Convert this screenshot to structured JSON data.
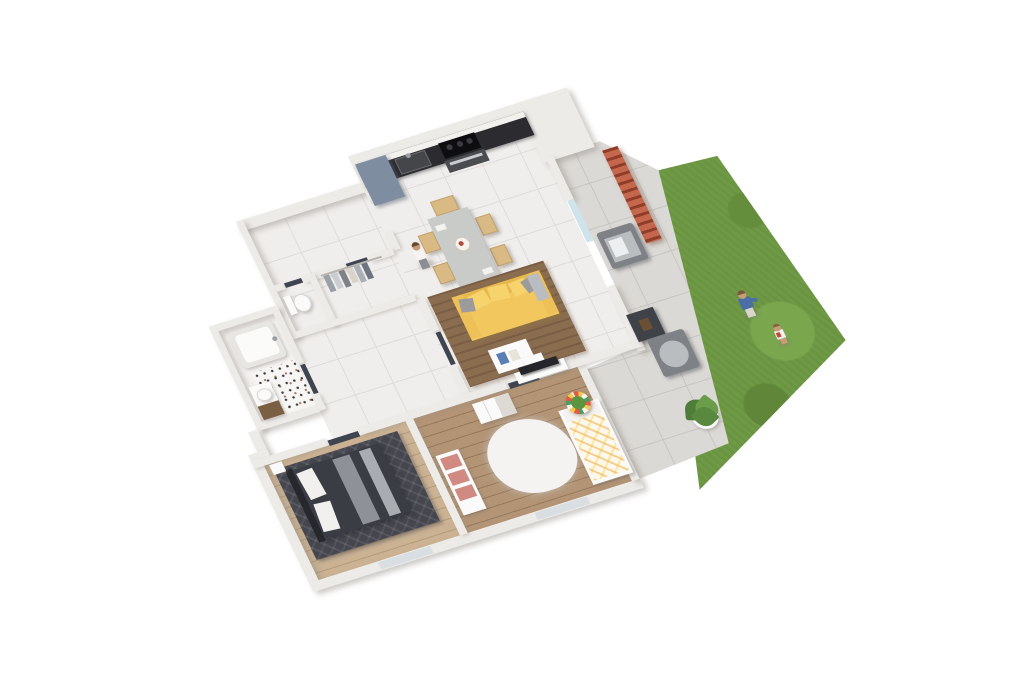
{
  "scene": {
    "type": "3d-architectural-floor-plan-render",
    "view": "axonometric top-down, plan rotated about 17 degrees",
    "background": "#ffffff",
    "text_visible": "none"
  },
  "palette": {
    "wall": "#edebe8",
    "door": "#3e4550",
    "tile": "#f0eeec",
    "tileLine": "#dedcd8",
    "pavement": "#dbd9d5",
    "paveLine": "#c7c5c1",
    "woodLight": "#cab293",
    "woodMid": "#b39475",
    "rugBrown": "#8a6c4f",
    "rugDark": "#45464e",
    "lawn": "#6f9a45",
    "brick": "#b25238",
    "glass": "#cfe3ea",
    "counter": "#2c2c30",
    "marble": "#f3f1ed",
    "fridge": "#7e8ea0",
    "sofaYellow": "#f2c85e",
    "sofaYellowDeep": "#e7b84e",
    "cushionYellow": "#f6d36c",
    "pillowGray": "#9b9b9b",
    "bedDark": "#3a3d44",
    "shelfPink": "#d08a82",
    "outdoorChair": "#7e8287",
    "plantGreen": "#4e7d3a"
  },
  "rooms": [
    {
      "id": "kitchen",
      "label": "Kitchen",
      "furniture": [
        "counter",
        "marble backsplash",
        "sink",
        "cooktop",
        "oven",
        "tall fridge unit"
      ]
    },
    {
      "id": "dining-area",
      "label": "Dining area",
      "furniture": [
        "gray dining table",
        "six wooden chairs",
        "centerpiece bowl"
      ]
    },
    {
      "id": "living-room",
      "label": "Living room",
      "furniture": [
        "yellow sofa",
        "gray pillows",
        "brown rug",
        "white coffee table",
        "tv on white bench"
      ]
    },
    {
      "id": "entry",
      "label": "Entry with closet",
      "furniture": [
        "clothes rack with hanging clothes"
      ]
    },
    {
      "id": "wc",
      "label": "WC",
      "furniture": [
        "toilet"
      ]
    },
    {
      "id": "bathroom",
      "label": "Bathroom",
      "furniture": [
        "bathtub",
        "vanity with wood drawer",
        "terrazzo floor area"
      ]
    },
    {
      "id": "hallway",
      "label": "Hallway",
      "furniture": [
        "doors to bedrooms and bathroom"
      ]
    },
    {
      "id": "master-bedroom",
      "label": "Master bedroom",
      "furniture": [
        "dark double bed",
        "white pillows",
        "dark patterned rug",
        "nightstand",
        "south window"
      ]
    },
    {
      "id": "kids-bedroom",
      "label": "Second bedroom",
      "furniture": [
        "colorful bed",
        "white shag rug",
        "white dresser",
        "shelf with pink boxes",
        "striped drum table with plant",
        "south window"
      ]
    }
  ],
  "outdoor": {
    "terrace": {
      "label": "Terrace",
      "items": [
        "brick privacy screen",
        "two gray outdoor armchairs",
        "dark side table",
        "potted plant"
      ]
    },
    "garden": {
      "label": "Garden lawn",
      "items": [
        "grass"
      ]
    }
  },
  "people": [
    {
      "id": "woman-dining",
      "description": "woman standing by dining table, white top, gray pants"
    },
    {
      "id": "adult-garden",
      "description": "adult on lawn, blue top"
    },
    {
      "id": "child-garden",
      "description": "toddler on lawn, white and red outfit"
    }
  ]
}
